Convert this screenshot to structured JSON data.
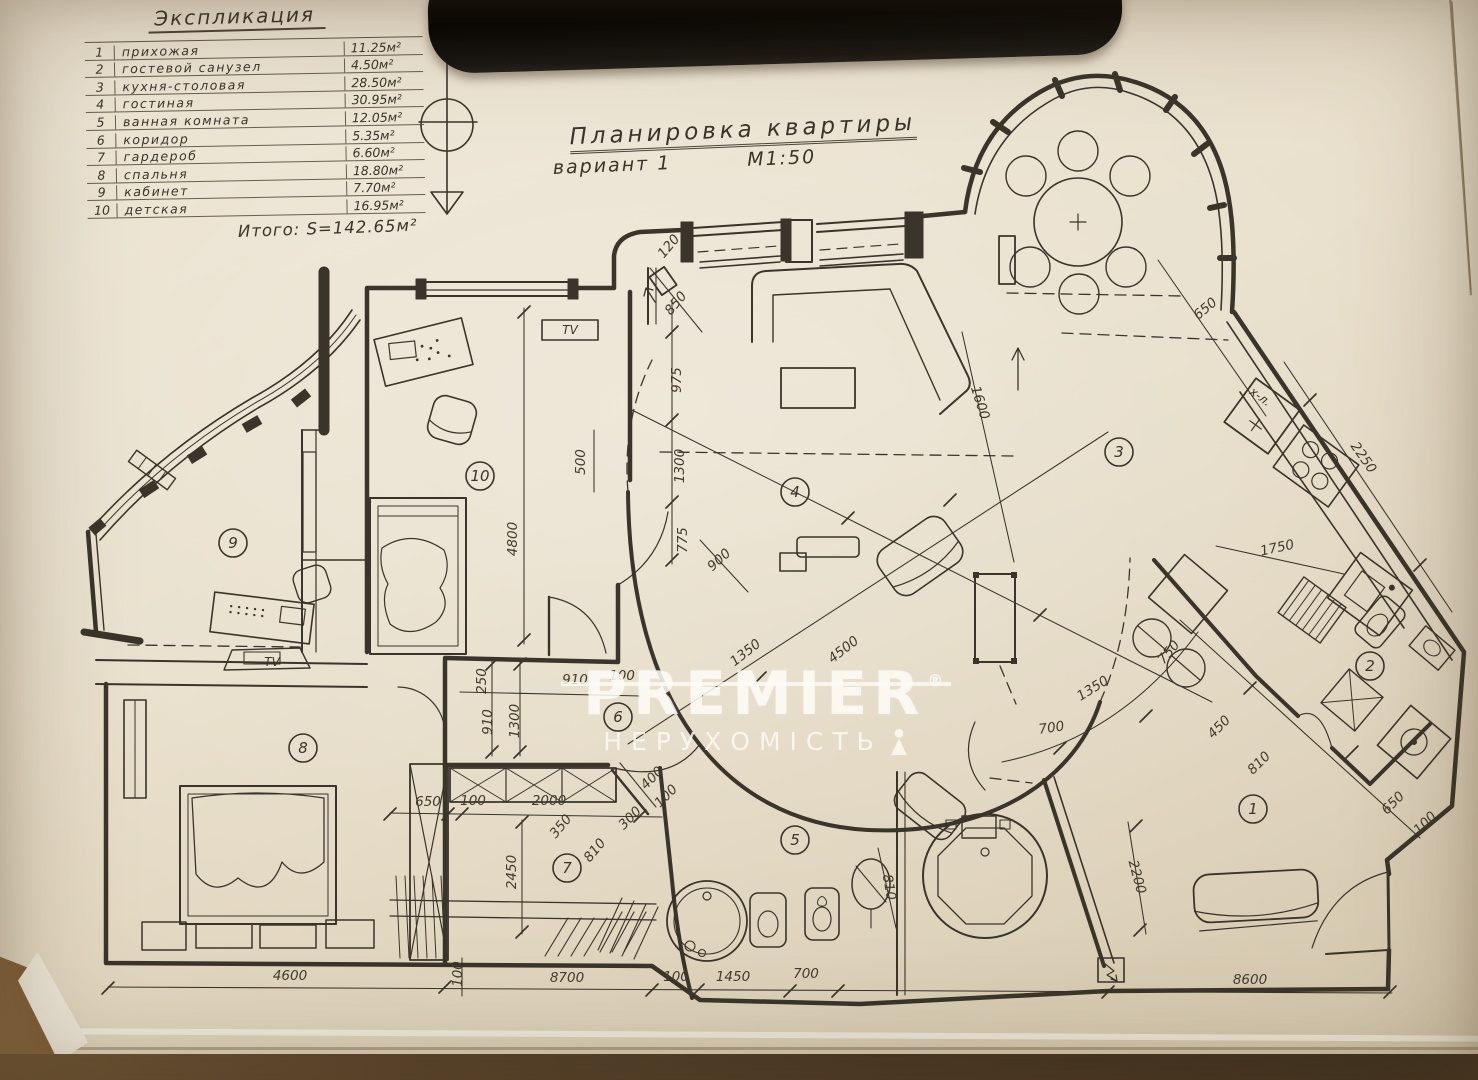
{
  "colors": {
    "paper": "#e9e0cd",
    "ink": "#3a342a",
    "table_wood": "#55412a",
    "watermark": "#fdfbf6"
  },
  "legend": {
    "title": "Экспликация",
    "rows": [
      {
        "num": "1",
        "name": "прихожая",
        "area": "11.25м²"
      },
      {
        "num": "2",
        "name": "гостевой санузел",
        "area": "4.50м²"
      },
      {
        "num": "3",
        "name": "кухня-столовая",
        "area": "28.50м²"
      },
      {
        "num": "4",
        "name": "гостиная",
        "area": "30.95м²"
      },
      {
        "num": "5",
        "name": "ванная комната",
        "area": "12.05м²"
      },
      {
        "num": "6",
        "name": "коридор",
        "area": "5.35м²"
      },
      {
        "num": "7",
        "name": "гардероб",
        "area": "6.60м²"
      },
      {
        "num": "8",
        "name": "спальня",
        "area": "18.80м²"
      },
      {
        "num": "9",
        "name": "кабинет",
        "area": "7.70м²"
      },
      {
        "num": "10",
        "name": "детская",
        "area": "16.95м²"
      }
    ],
    "total": "Итого: S=142.65м²"
  },
  "title_block": {
    "line1": "Планировка квартиры",
    "line2": "вариант 1",
    "scale": "М1:50"
  },
  "watermark": {
    "brand": "PREMIER",
    "reg": "®",
    "sub": "НЕРУХОМІСТЬ"
  },
  "room_labels": [
    {
      "num": "1",
      "x": 1253,
      "y": 809
    },
    {
      "num": "2",
      "x": 1370,
      "y": 666
    },
    {
      "num": "3",
      "x": 1119,
      "y": 452
    },
    {
      "num": "4",
      "x": 795,
      "y": 492
    },
    {
      "num": "5",
      "x": 795,
      "y": 840
    },
    {
      "num": "6",
      "x": 618,
      "y": 717
    },
    {
      "num": "7",
      "x": 567,
      "y": 868
    },
    {
      "num": "8",
      "x": 303,
      "y": 748
    },
    {
      "num": "9",
      "x": 233,
      "y": 543
    },
    {
      "num": "10",
      "x": 480,
      "y": 476
    }
  ],
  "dim_labels": [
    {
      "t": "4600",
      "x": 290,
      "y": 980,
      "r": 0
    },
    {
      "t": "8700",
      "x": 567,
      "y": 982,
      "r": 0
    },
    {
      "t": "100",
      "x": 676,
      "y": 981,
      "r": 0
    },
    {
      "t": "1450",
      "x": 733,
      "y": 981,
      "r": 0
    },
    {
      "t": "700",
      "x": 806,
      "y": 978,
      "r": 0
    },
    {
      "t": "8600",
      "x": 1250,
      "y": 984,
      "r": 0
    },
    {
      "t": "100",
      "x": 462,
      "y": 974,
      "r": -90
    },
    {
      "t": "650",
      "x": 428,
      "y": 806,
      "r": 0
    },
    {
      "t": "100",
      "x": 473,
      "y": 805,
      "r": 0
    },
    {
      "t": "2000",
      "x": 549,
      "y": 805,
      "r": 0
    },
    {
      "t": "2450",
      "x": 516,
      "y": 872,
      "r": -90
    },
    {
      "t": "350",
      "x": 564,
      "y": 829,
      "r": -50
    },
    {
      "t": "810",
      "x": 598,
      "y": 853,
      "r": -50
    },
    {
      "t": "300",
      "x": 633,
      "y": 821,
      "r": -45
    },
    {
      "t": "400",
      "x": 655,
      "y": 781,
      "r": -45
    },
    {
      "t": "100",
      "x": 669,
      "y": 799,
      "r": -45
    },
    {
      "t": "910",
      "x": 575,
      "y": 684,
      "r": 0
    },
    {
      "t": "100",
      "x": 622,
      "y": 680,
      "r": 0
    },
    {
      "t": "250",
      "x": 486,
      "y": 681,
      "r": -90
    },
    {
      "t": "910",
      "x": 492,
      "y": 722,
      "r": -90
    },
    {
      "t": "1300",
      "x": 519,
      "y": 721,
      "r": -90
    },
    {
      "t": "4800",
      "x": 517,
      "y": 539,
      "r": -90
    },
    {
      "t": "500",
      "x": 585,
      "y": 462,
      "r": -90
    },
    {
      "t": "975",
      "x": 681,
      "y": 380,
      "r": -90
    },
    {
      "t": "1300",
      "x": 684,
      "y": 466,
      "r": -90
    },
    {
      "t": "775",
      "x": 687,
      "y": 540,
      "r": -90
    },
    {
      "t": "120",
      "x": 672,
      "y": 249,
      "r": -50
    },
    {
      "t": "850",
      "x": 679,
      "y": 306,
      "r": -50
    },
    {
      "t": "900",
      "x": 722,
      "y": 563,
      "r": -42
    },
    {
      "t": "4500",
      "x": 846,
      "y": 653,
      "r": -38
    },
    {
      "t": "1350",
      "x": 748,
      "y": 656,
      "r": -38
    },
    {
      "t": "1350",
      "x": 1095,
      "y": 692,
      "r": -32
    },
    {
      "t": "750",
      "x": 1172,
      "y": 655,
      "r": -50
    },
    {
      "t": "700",
      "x": 1052,
      "y": 732,
      "r": -8
    },
    {
      "t": "1600",
      "x": 976,
      "y": 404,
      "r": 72
    },
    {
      "t": "650",
      "x": 1208,
      "y": 312,
      "r": -40
    },
    {
      "t": "2250",
      "x": 1360,
      "y": 460,
      "r": 55
    },
    {
      "t": "1750",
      "x": 1278,
      "y": 552,
      "r": -12
    },
    {
      "t": "450",
      "x": 1222,
      "y": 730,
      "r": -45
    },
    {
      "t": "810",
      "x": 1262,
      "y": 766,
      "r": -45
    },
    {
      "t": "650",
      "x": 1396,
      "y": 806,
      "r": -45
    },
    {
      "t": "100",
      "x": 1428,
      "y": 826,
      "r": -45
    },
    {
      "t": "2200",
      "x": 1133,
      "y": 878,
      "r": 75
    },
    {
      "t": "810",
      "x": 885,
      "y": 888,
      "r": 80
    }
  ],
  "annotations": [
    {
      "t": "TV",
      "x": 570,
      "y": 334,
      "r": 0
    },
    {
      "t": "TV",
      "x": 272,
      "y": 666,
      "r": 0
    },
    {
      "t": "х-л.",
      "x": 1258,
      "y": 400,
      "r": 36
    }
  ]
}
